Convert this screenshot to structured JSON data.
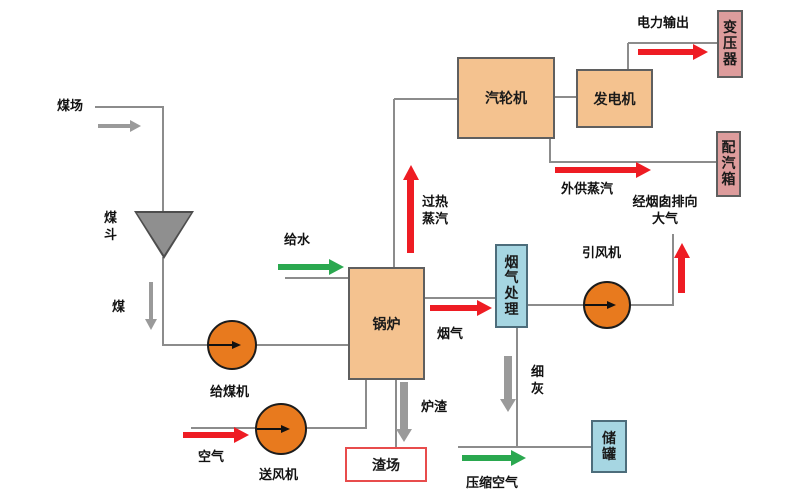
{
  "boxes": {
    "turbine": "汽轮机",
    "generator": "发电机",
    "boiler": "锅炉",
    "transformer": "变压器",
    "steam_distributor": "配汽箱",
    "flue_gas_treatment": "烟气处理",
    "storage_tank": "储罐",
    "slag_yard": "渣场"
  },
  "circles": {
    "coal_feeder": "给煤机",
    "fd_fan": "送风机",
    "id_fan": "引风机"
  },
  "labels": {
    "coal_yard": "煤场",
    "coal_hopper": "煤斗",
    "coal": "煤",
    "air": "空气",
    "feed_water": "给水",
    "superheated_steam": "过热蒸汽",
    "flue_gas": "烟气",
    "chimney_exhaust": "经烟囱排向大气",
    "fine_ash": "细灰",
    "slag": "炉渣",
    "compressed_air": "压缩空气",
    "external_steam": "外供蒸汽",
    "power_output": "电力输出"
  },
  "colors": {
    "process_box": "#f4c28f",
    "output_box": "#dd9c9c",
    "treatment_box": "#a6d6e2",
    "fan_circle": "#e87a1e",
    "hopper": "#8f8f8f",
    "slag_yard_border": "#e84c4c",
    "arrow_red": "#ee1c23",
    "arrow_green": "#2aa84f",
    "arrow_gray": "#9a9a9a",
    "line_gray": "#8c8c8c"
  }
}
